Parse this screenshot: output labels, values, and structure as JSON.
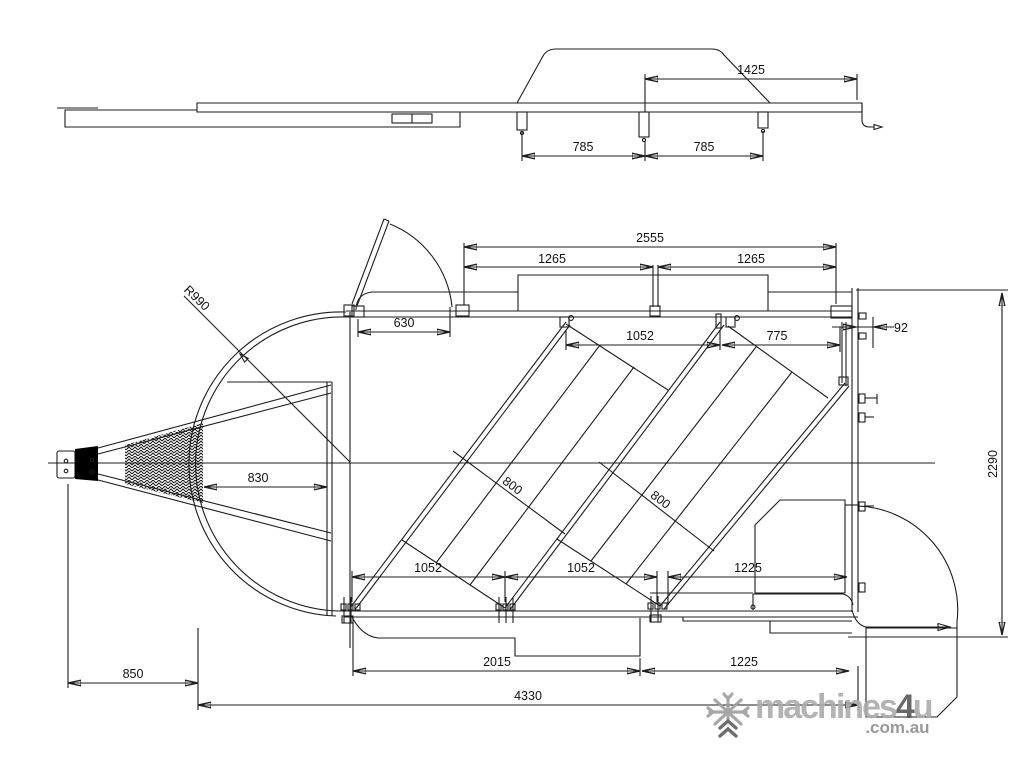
{
  "page": {
    "background": "#ffffff",
    "line_color": "#1c1c1c",
    "watermark_color": "#ababab"
  },
  "drawing": {
    "side_view": {
      "dim_1425": "1425",
      "dim_785_left": "785",
      "dim_785_right": "785"
    },
    "plan_view": {
      "dim_2555": "2555",
      "dim_1265_left": "1265",
      "dim_1265_right": "1265",
      "dim_630": "630",
      "dim_1052_top": "1052",
      "dim_775": "775",
      "dim_92": "92",
      "radius_front": "R990",
      "dim_830": "830",
      "dim_800_left": "800",
      "dim_800_right": "800",
      "dim_1052_bottom_left": "1052",
      "dim_1052_bottom_mid": "1052",
      "dim_1225_upper": "1225",
      "dim_2015": "2015",
      "dim_1225_lower": "1225",
      "dim_850": "850",
      "dim_4330": "4330",
      "dim_2290": "2290"
    }
  },
  "watermark": {
    "brand_prefix": "machines",
    "brand_number": "4",
    "brand_suffix": "u",
    "domain_suffix": ".com.au",
    "icon": "snowflake-icon"
  }
}
